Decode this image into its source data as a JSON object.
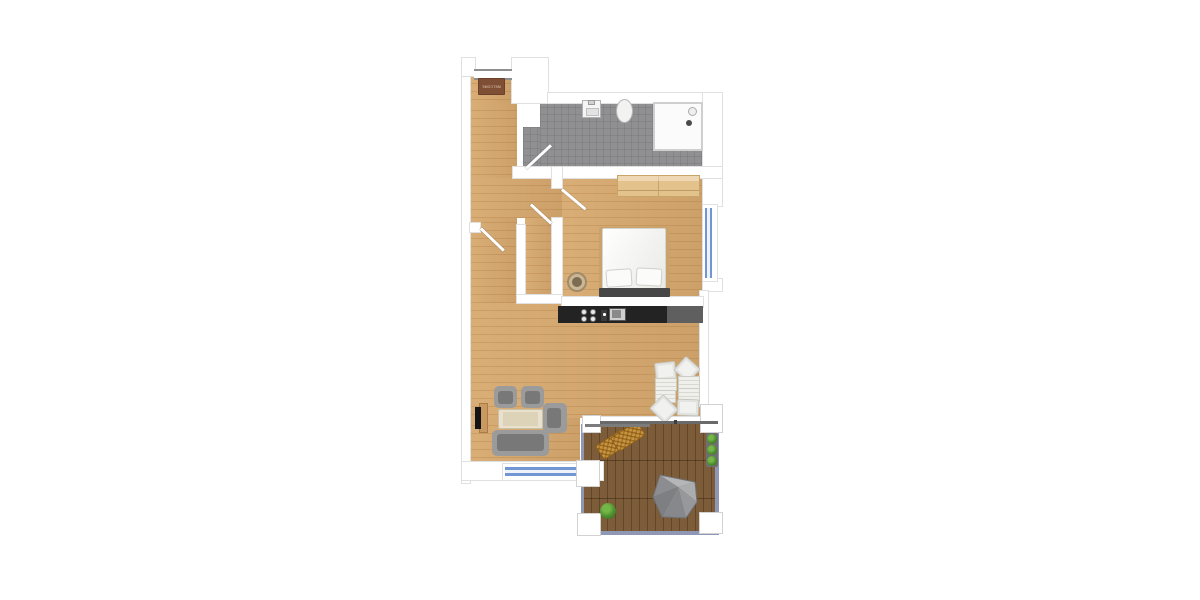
{
  "scene": {
    "type": "apartment-floor-plan",
    "view": "top-down",
    "background": "#ffffff"
  },
  "entrance": {
    "doormat_label": "WELCOME"
  },
  "areas": {
    "entrance_hall": {
      "items": [
        "doormat",
        "entrance-door"
      ]
    },
    "bathroom": {
      "items": [
        "sink",
        "toilet",
        "shower",
        "bathroom-door"
      ]
    },
    "bedroom": {
      "items": [
        "wardrobe",
        "double-bed",
        "pillows",
        "headboard",
        "basket",
        "bedroom-door",
        "bedroom-window"
      ]
    },
    "kitchen": {
      "items": [
        "counter",
        "cooktop",
        "kitchen-sink"
      ]
    },
    "living_dining": {
      "items": [
        "tv",
        "tv-board",
        "armchair",
        "armchair",
        "armchair",
        "coffee-table",
        "sofa",
        "dining-chairs",
        "dining-tables",
        "living-room-window"
      ]
    },
    "closet": {
      "items": [
        "closet-door"
      ]
    },
    "terrace": {
      "items": [
        "deck",
        "railing",
        "corner-posts",
        "loungers",
        "parasol",
        "planter",
        "bush",
        "sliding-door"
      ]
    }
  },
  "doors": [
    "entrance-door",
    "bathroom-door",
    "closet-door",
    "bedroom-door",
    "hallway-door",
    "terrace-sliding-door"
  ],
  "windows": [
    "bedroom-window",
    "living-room-window"
  ],
  "colors": {
    "wood_floor": "#d7a96e",
    "bathroom_tile": "#909092",
    "wall": "#ffffff",
    "wall_outline": "#e0e0e0",
    "kitchen_counter_dark": "#232323",
    "kitchen_counter_light": "#5f5f5f",
    "window_glass": "#7296d4",
    "terrace_deck": "#7d5c3a",
    "railing": "#8e97b3",
    "sofa_gray": "#9b9b9b",
    "sofa_seat": "#787878",
    "coffee_table": "#e9e1cd",
    "wardrobe_wood": "#e4c28c",
    "doormat_brown": "#7e4f35",
    "doormat_text": "#e8cdbc",
    "parasol_gray": "#8c8e92",
    "plant_green": "#4e8f2f",
    "lounger_wicker": "#c6953f",
    "bed_white": "#f4f4f2",
    "headboard_dark": "#474747",
    "door_slab": "#8f8f8f"
  }
}
